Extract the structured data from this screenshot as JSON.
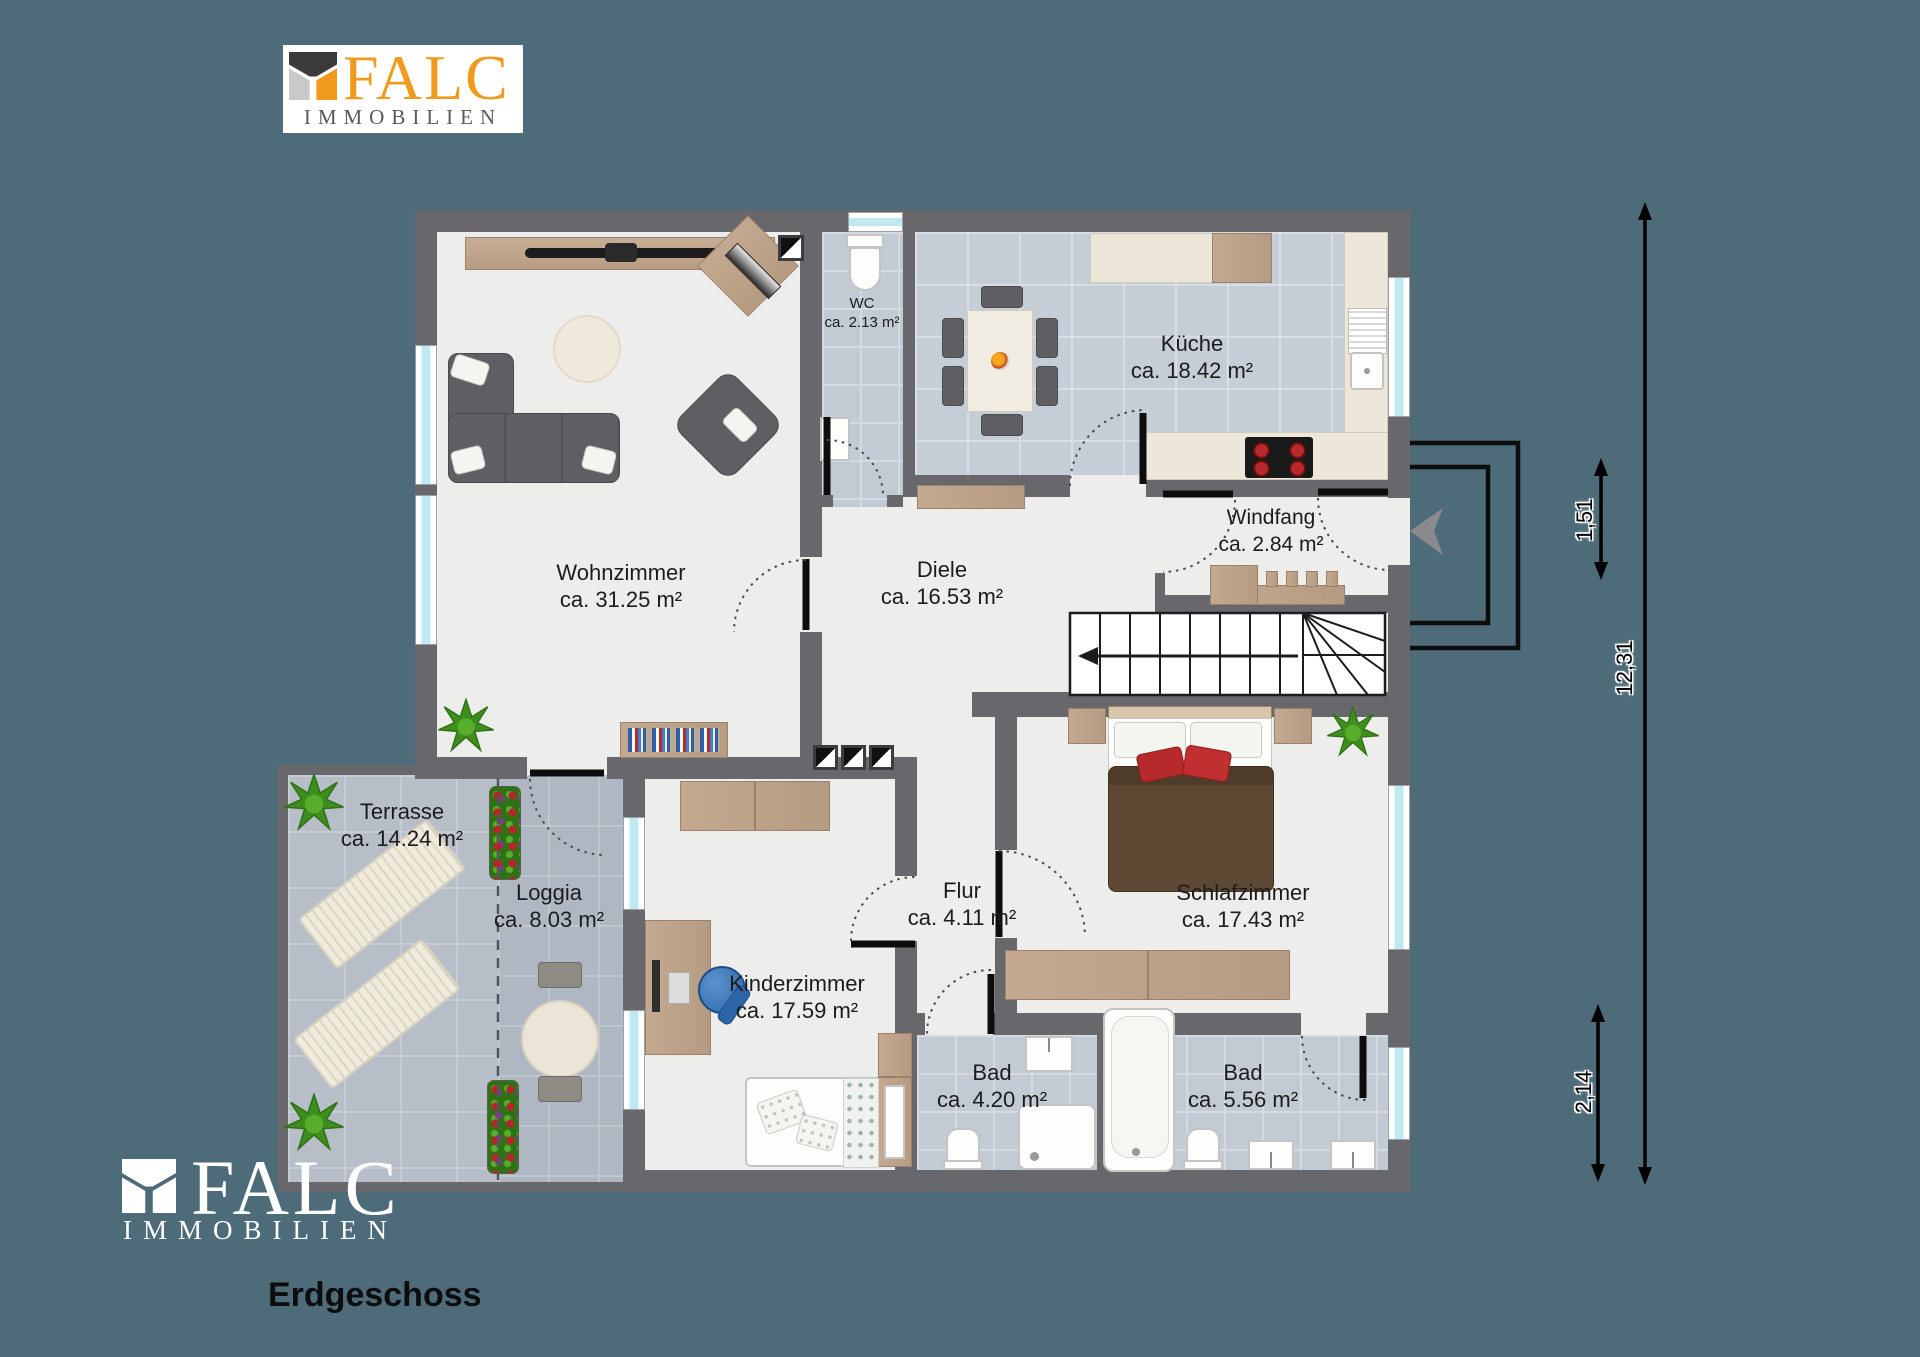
{
  "branding": {
    "name": "FALC",
    "subtitle": "IMMOBILIEN",
    "accent_orange": "#F09B1E",
    "logo_dark": "#3B3B3E",
    "logo_gray": "#C9C9C9"
  },
  "floor_title": "Erdgeschoss",
  "rooms": [
    {
      "id": "wohnzimmer",
      "name": "Wohnzimmer",
      "area": "ca. 31.25 m²"
    },
    {
      "id": "wc",
      "name": "WC",
      "area": "ca. 2.13 m²"
    },
    {
      "id": "kueche",
      "name": "Küche",
      "area": "ca. 18.42 m²"
    },
    {
      "id": "windfang",
      "name": "Windfang",
      "area": "ca. 2.84 m²"
    },
    {
      "id": "diele",
      "name": "Diele",
      "area": "ca. 16.53 m²"
    },
    {
      "id": "terrasse",
      "name": "Terrasse",
      "area": "ca. 14.24 m²"
    },
    {
      "id": "loggia",
      "name": "Loggia",
      "area": "ca. 8.03 m²"
    },
    {
      "id": "kinderzimmer",
      "name": "Kinderzimmer",
      "area": "ca. 17.59 m²"
    },
    {
      "id": "flur",
      "name": "Flur",
      "area": "ca. 4.11 m²"
    },
    {
      "id": "schlafzimmer",
      "name": "Schlafzimmer",
      "area": "ca. 17.43 m²"
    },
    {
      "id": "bad_klein",
      "name": "Bad",
      "area": "ca. 4.20 m²"
    },
    {
      "id": "bad_gross",
      "name": "Bad",
      "area": "ca. 5.56 m²"
    }
  ],
  "dimensions": {
    "total_height": "12,31",
    "entrance": "1,51",
    "lower_right": "2,14"
  },
  "colors": {
    "background": "#4D6B78",
    "wall": "#67676C",
    "tile": "#C5CDD6",
    "window_glass": "#BEE9F2"
  }
}
